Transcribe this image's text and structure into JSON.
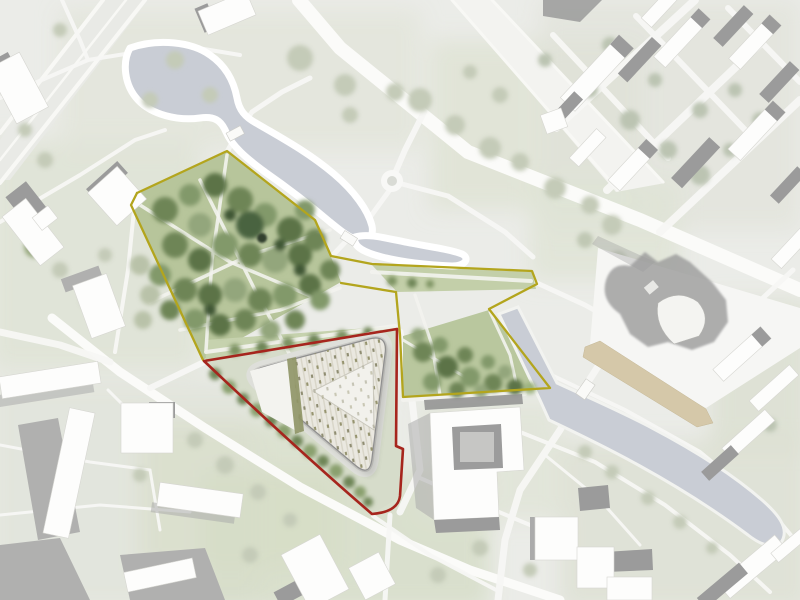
{
  "map": {
    "kind": "architectural-masterplan-site-plan",
    "visible_text": "none",
    "palette": {
      "paper": "#ebece8",
      "water": "#c9cdd5",
      "boundary_red": "#a6251d",
      "boundary_yellow": "#b3a51d",
      "park_green": "#b7c59b",
      "lawn_band": "#c6d2ae",
      "boardwalk_tan": "#d5c8a9",
      "roof_stripe": "#d9d6c9",
      "roof_base": "#eae8e0",
      "roof_dot": "#8f8d72",
      "courtyard": "#f2f1ec",
      "olive_strip": "#8e9465",
      "building_white": "#fdfdfc",
      "building_shadow": "#9b9b9b"
    },
    "boundaries": {
      "realization_red": {
        "color": "#a6251d",
        "d": "M 204,361 L 397,329 L 396,446 L 403,449 L 400,496 Q 398,512 372,514 Q 300,452 204,361 Z"
      },
      "study_yellow_main": {
        "color": "#b3a51d",
        "d": "M 137,193 L 227,151 L 315,220 L 331,256 L 372,264 L 532,271 L 537,284 L 489,309 L 550,388 L 403,397 L 400,335 L 396,292 L 341,283"
      },
      "study_yellow_west": {
        "color": "#b3a51d",
        "d": "M 137,193 L 131,205 L 203,360"
      }
    },
    "water": {
      "fill": "#c9cdd5",
      "lake_d": "M 130,48 C 158,38 192,42 210,55 C 226,66 234,82 237,98 C 239,110 245,117 256,123 C 280,137 308,152 334,174 C 354,191 368,210 372,226 C 374,236 368,243 358,240 C 348,237 340,230 330,222 C 310,205 288,188 265,172 C 246,158 232,146 226,132 C 221,120 214,116 200,118 C 178,121 152,115 138,100 C 124,85 122,62 130,48 Z",
      "pond_d": "M 355,237 C 368,233 385,238 410,243 C 432,247 452,250 462,254 C 470,258 466,266 452,266 C 428,265 402,262 382,257 C 366,253 352,247 355,237 Z",
      "canal_d": "M 499,314 L 518,307 L 557,383 C 585,396 620,411 652,428 C 690,448 730,472 762,500 C 778,514 788,527 783,539 C 778,551 762,546 748,535 C 716,511 678,487 640,466 C 604,446 570,430 549,420 L 540,400 Z"
    },
    "boardwalk": {
      "fill": "#d5c8a9",
      "points": "585,347 600,341 706,409 713,423 697,427 583,357"
    },
    "landmark_building": {
      "roof_d": "M 369,339 L 264,367 Q 245,372 260,385 L 355,465 Q 370,478 372,458 L 385,354 Q 388,334 369,339 Z",
      "courtyard_points": "313,391 373,361 374,430",
      "green_strip_points": "287,359 296,357 304,431 295,434"
    },
    "lawns": {
      "park_points": "137,193 227,151 315,220 331,257 341,282 203,360 131,205",
      "lawn_band_points": "205,340 396,326 398,341 206,361",
      "arm_band_points": "372,265 532,272 536,289 397,292",
      "grove_points": "403,336 489,310 549,388 403,397",
      "red_interior_points": "204,361 397,329 396,446 403,449 400,497 372,514 300,450"
    }
  }
}
